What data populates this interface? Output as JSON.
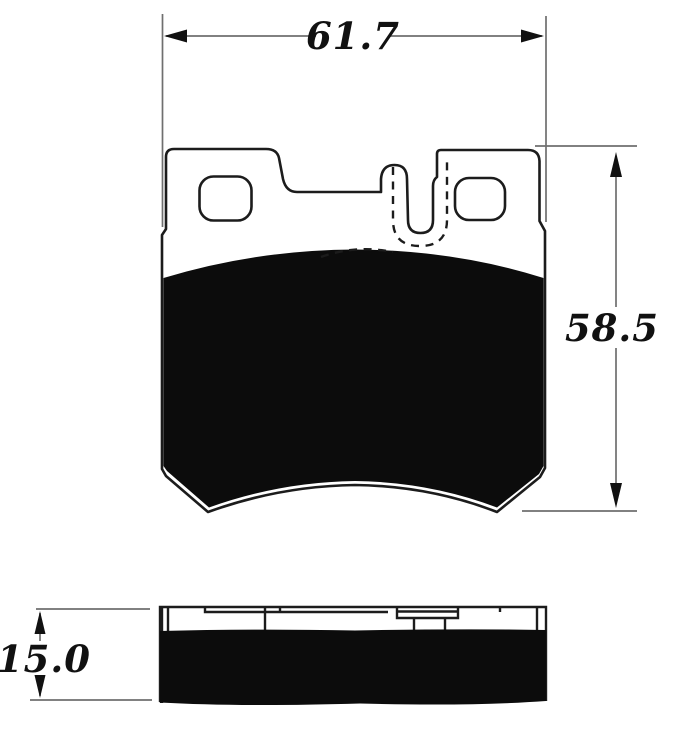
{
  "drawing": {
    "kind": "brake-pad technical drawing with front view, side view and dimension callouts",
    "dimensions": {
      "width": "61.7",
      "height": "58.5",
      "thickness": "15.0"
    },
    "colors": {
      "background": "#ffffff",
      "outline": "#1c1c1c",
      "friction_fill": "#0c0c0c",
      "dimension_line": "#6f6f6f",
      "label_text": "#111111"
    }
  }
}
